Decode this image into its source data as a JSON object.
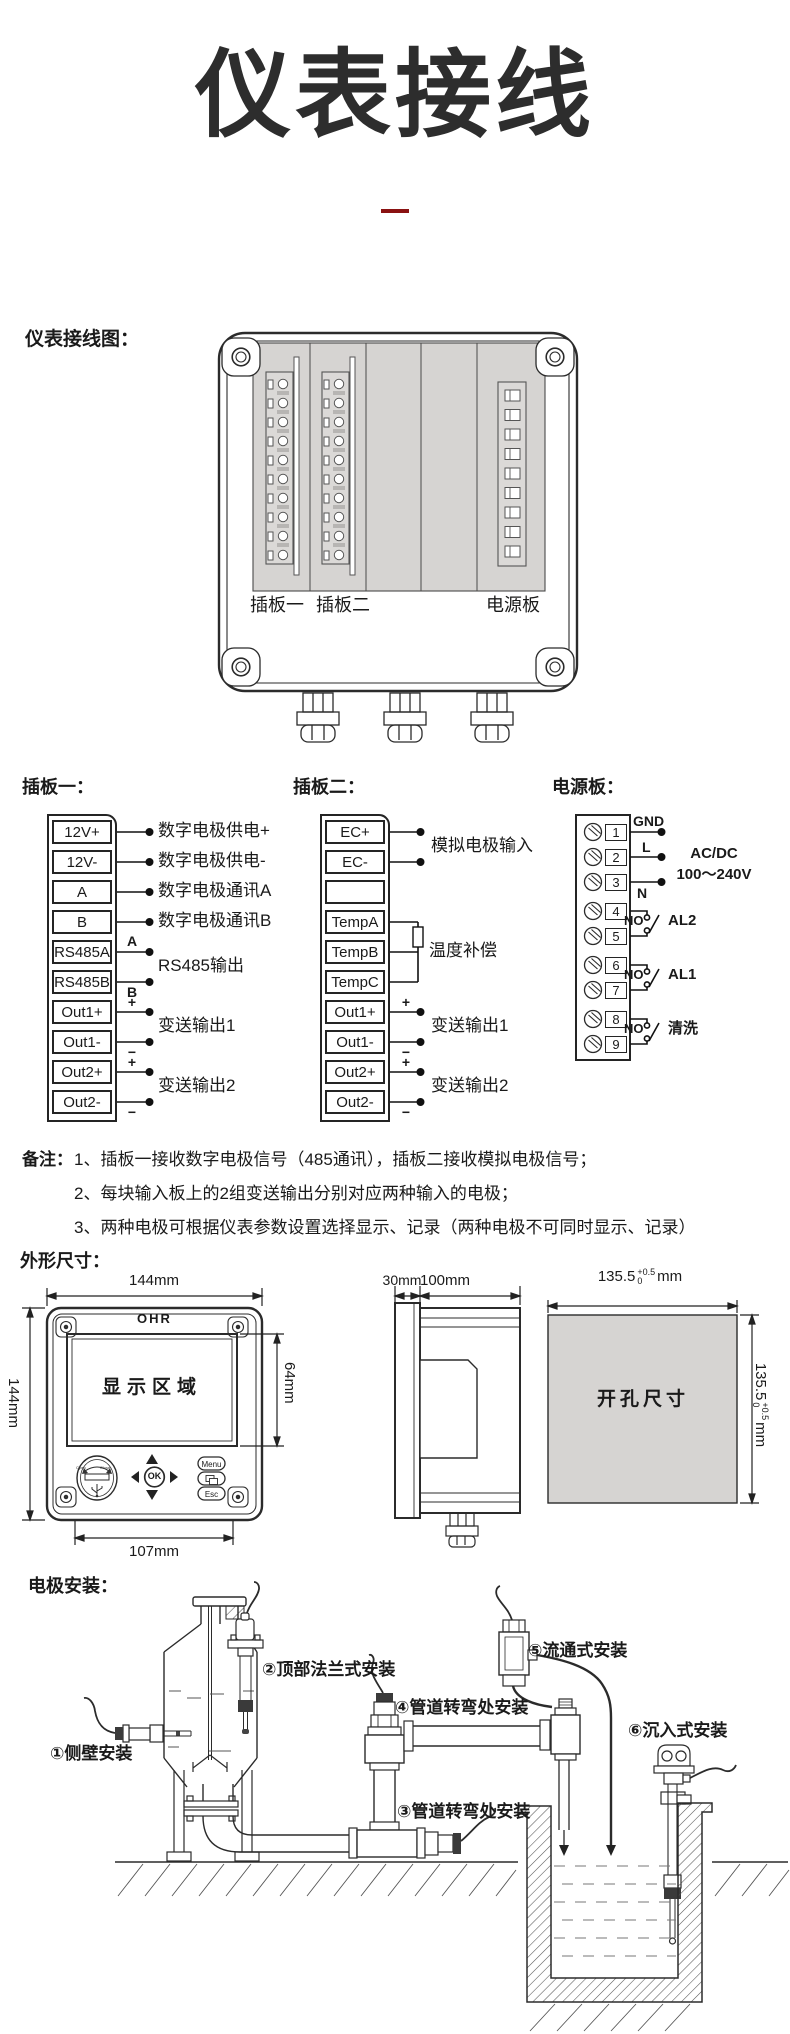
{
  "header": {
    "title": "仪表接线"
  },
  "labels": {
    "wiring_diagram": "仪表接线图：",
    "notes": "备注：",
    "dimensions": "外形尺寸：",
    "install": "电极安装："
  },
  "device": {
    "board1": "插板一",
    "board2": "插板二",
    "power": "电源板"
  },
  "board1": {
    "title": "插板一：",
    "terminals": [
      "12V+",
      "12V-",
      "A",
      "B",
      "RS485A",
      "RS485B",
      "Out1+",
      "Out1-",
      "Out2+",
      "Out2-"
    ],
    "descriptions": {
      "supply_plus": "数字电极供电+",
      "supply_minus": "数字电极供电-",
      "comm_a": "数字电极通讯A",
      "comm_b": "数字电极通讯B",
      "rs485": "RS485输出",
      "out1": "变送输出1",
      "out2": "变送输出2"
    }
  },
  "board2": {
    "title": "插板二：",
    "terminals": [
      "EC+",
      "EC-",
      "",
      "TempA",
      "TempB",
      "TempC",
      "Out1+",
      "Out1-",
      "Out2+",
      "Out2-"
    ],
    "descriptions": {
      "analog_in": "模拟电极输入",
      "temp_comp": "温度补偿",
      "out1": "变送输出1",
      "out2": "变送输出2"
    }
  },
  "power_board": {
    "title": "电源板：",
    "terminals": [
      "1",
      "2",
      "3",
      "4",
      "5",
      "6",
      "7",
      "8",
      "9"
    ],
    "gnd": "GND",
    "live": "L",
    "neutral": "N",
    "supply_line1": "AC/DC",
    "supply_line2": "100～240V",
    "no": "NO",
    "al2": "AL2",
    "al1": "AL1",
    "wash": "清洗"
  },
  "marks": {
    "a": "A",
    "b": "B",
    "plus": "+",
    "minus": "−"
  },
  "notes": {
    "line1": "1、插板一接收数字电极信号（485通讯），插板二接收模拟电极信号；",
    "line2": "2、每块输入板上的2组变送输出分别对应两种输入的电极；",
    "line3": "3、两种电极可根据仪表参数设置选择显示、记录（两种电极不可同时显示、记录）"
  },
  "front_view": {
    "brand": "OHR",
    "display_area": "显示区域",
    "ok": "OK",
    "menu": "Menu",
    "esc": "Esc",
    "usb_open": "Open",
    "usb_close": "Close",
    "dim_width": "144mm",
    "dim_height": "144mm",
    "dim_screen": "64mm",
    "dim_bottom": "107mm"
  },
  "side_view": {
    "dim_bezel": "30mm",
    "dim_body": "100mm"
  },
  "cutout": {
    "label": "开孔尺寸",
    "dim": "135.5",
    "tol_up": "+0.5",
    "tol_dn": "0",
    "unit": "mm"
  },
  "install": {
    "item1": "①侧壁安装",
    "item2": "②顶部法兰式安装",
    "item3": "③管道转弯处安装",
    "item4": "④管道转弯处安装",
    "item5": "⑤流通式安装",
    "item6": "⑥沉入式安装"
  },
  "colors": {
    "accent_red": "#8a1212",
    "panel_gray": "#d6d4d2",
    "ink": "#1a1a1a"
  }
}
